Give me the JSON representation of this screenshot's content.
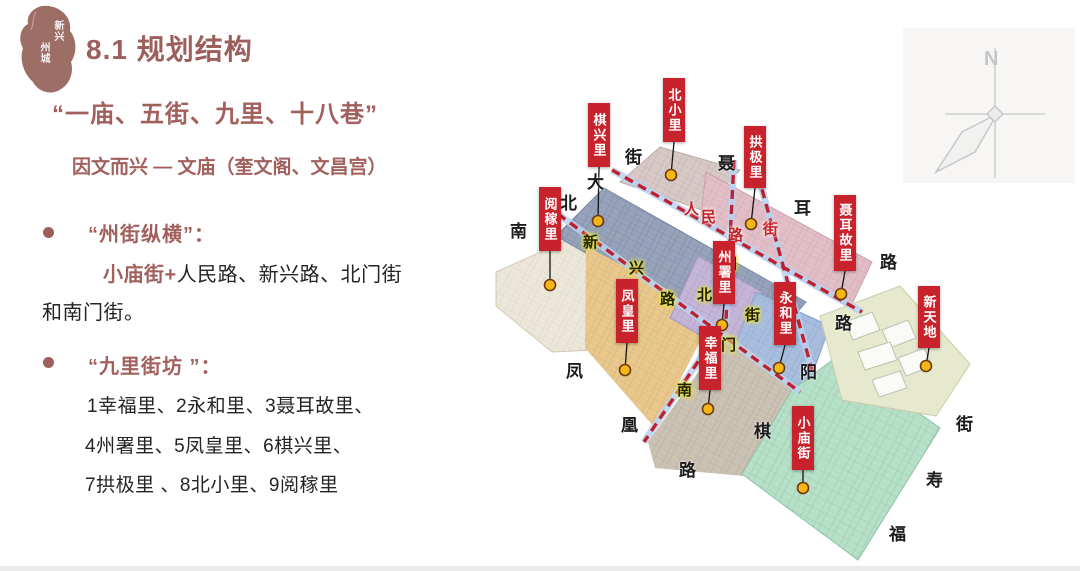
{
  "slide": {
    "logo": {
      "line1": "新兴",
      "line2": "州城"
    },
    "title": "8.1 规划结构",
    "subtitle": "“一庙、五街、九里、十八巷”",
    "tagline": "因文而兴 — 文庙（奎文阁、文昌宫）",
    "section1": {
      "heading": "“州街纵横”：",
      "lead": "小庙街+",
      "rest": "人民路、新兴路、北门街",
      "line2": "和南门街。"
    },
    "section2": {
      "heading": "“九里街坊 ”：",
      "items": [
        "1幸福里、2永和里、3聂耳故里、",
        "4州署里、5凤皇里、6棋兴里、",
        "7拱极里 、8北小里、9阅稼里"
      ]
    }
  },
  "map": {
    "compass_n": "N",
    "labels": [
      "棋兴里",
      "北小里",
      "拱极里",
      "阅稼里",
      "聂耳故里",
      "州署里",
      "永和里",
      "新天地",
      "凤皇里",
      "幸福里",
      "小庙街"
    ],
    "road_chars_yellow": [
      "新",
      "兴",
      "路",
      "北",
      "门",
      "街",
      "门",
      "南"
    ],
    "road_chars_red": [
      "人",
      "民",
      "路",
      "街"
    ],
    "perimeter_chars": [
      "街",
      "大",
      "北",
      "南",
      "聂",
      "耳",
      "路",
      "路",
      "阳",
      "棋",
      "凤",
      "凰",
      "路",
      "街",
      "寿",
      "福"
    ],
    "colors": {
      "label_red": "#c8232c",
      "road_dash_red": "#c0202e",
      "road_casing_blue": "#b9d2f0",
      "marker_yellow": "#f5b616",
      "accent_brown": "#9c5f5c"
    }
  }
}
